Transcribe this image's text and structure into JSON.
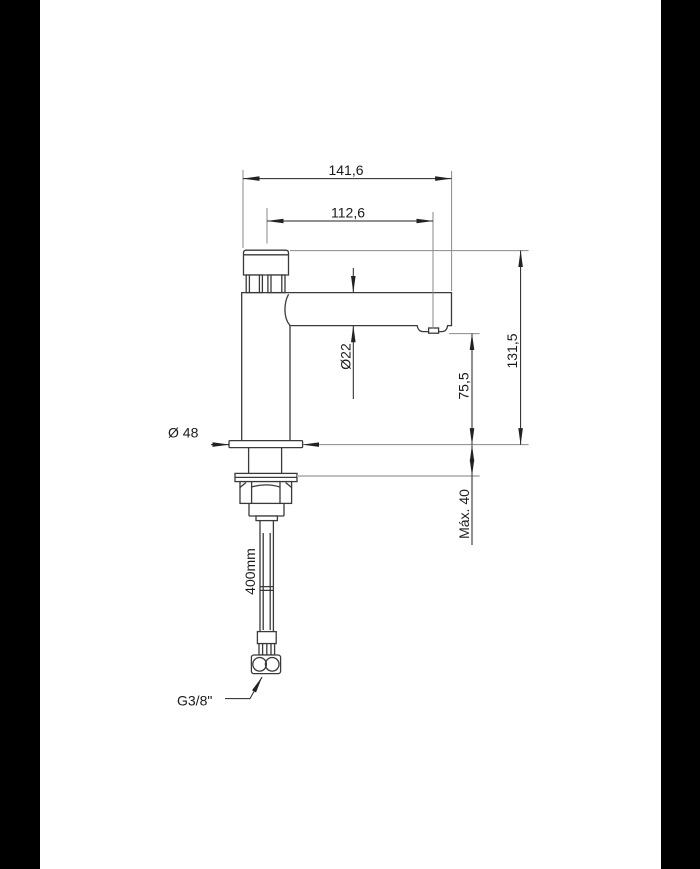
{
  "drawing": {
    "type": "technical-dimension-drawing",
    "subject": "Single-hole basin faucet, side elevation with flexible supply hose",
    "colors": {
      "letterbox": "#000000",
      "page_background": "#ffffff",
      "dimension_ink": "#222222",
      "profile_ink": "#3a3a3a",
      "extension_line": "#8a8a8a",
      "counter_line": "#b5b5b5"
    },
    "labels": {
      "total_width": "141,6",
      "spout_reach": "112,6",
      "total_height": "131,5",
      "outlet_height": "75,5",
      "spout_diameter": "Ø22",
      "base_diameter": "Ø 48",
      "max_deck_thickness": "Máx. 40",
      "hose_length": "400mm",
      "thread_size": "G3/8\""
    }
  }
}
